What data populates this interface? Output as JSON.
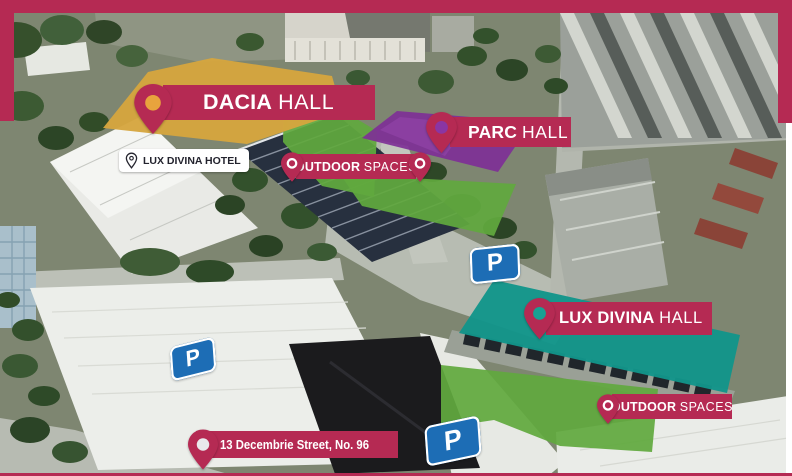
{
  "frame": {
    "accent": "#b52a53",
    "background": "#ffffff"
  },
  "overlays": {
    "dacia_roof": "#d5a53e",
    "parc_roof": "#7e3096",
    "lux_roof": "#12958a",
    "outdoor_green": "#61a93e",
    "parking_blue": "#1d6db5"
  },
  "markers": {
    "dacia": {
      "name_bold": "DACIA",
      "name_regular": "HALL",
      "pin_color": "#e8a33d"
    },
    "parc": {
      "name_bold": "PARC",
      "name_regular": "HALL",
      "pin_color": "#8a35a3"
    },
    "lux": {
      "name_bold": "LUX DIVINA",
      "name_regular": "HALL",
      "pin_color": "#17a193"
    },
    "outdoor1": {
      "name_bold": "OUTDOOR",
      "name_regular": "SPACES",
      "pin_color": "#b52a53"
    },
    "outdoor2": {
      "name_bold": "OUTDOOR",
      "name_regular": "SPACES",
      "pin_color": "#b52a53"
    },
    "hotel": {
      "label": "LUX DIVINA HOTEL"
    },
    "address": {
      "label": "13 Decembrie Street, No. 96",
      "pin_color": "#e9e9ec"
    }
  },
  "parking": {
    "sign_letter": "P"
  }
}
